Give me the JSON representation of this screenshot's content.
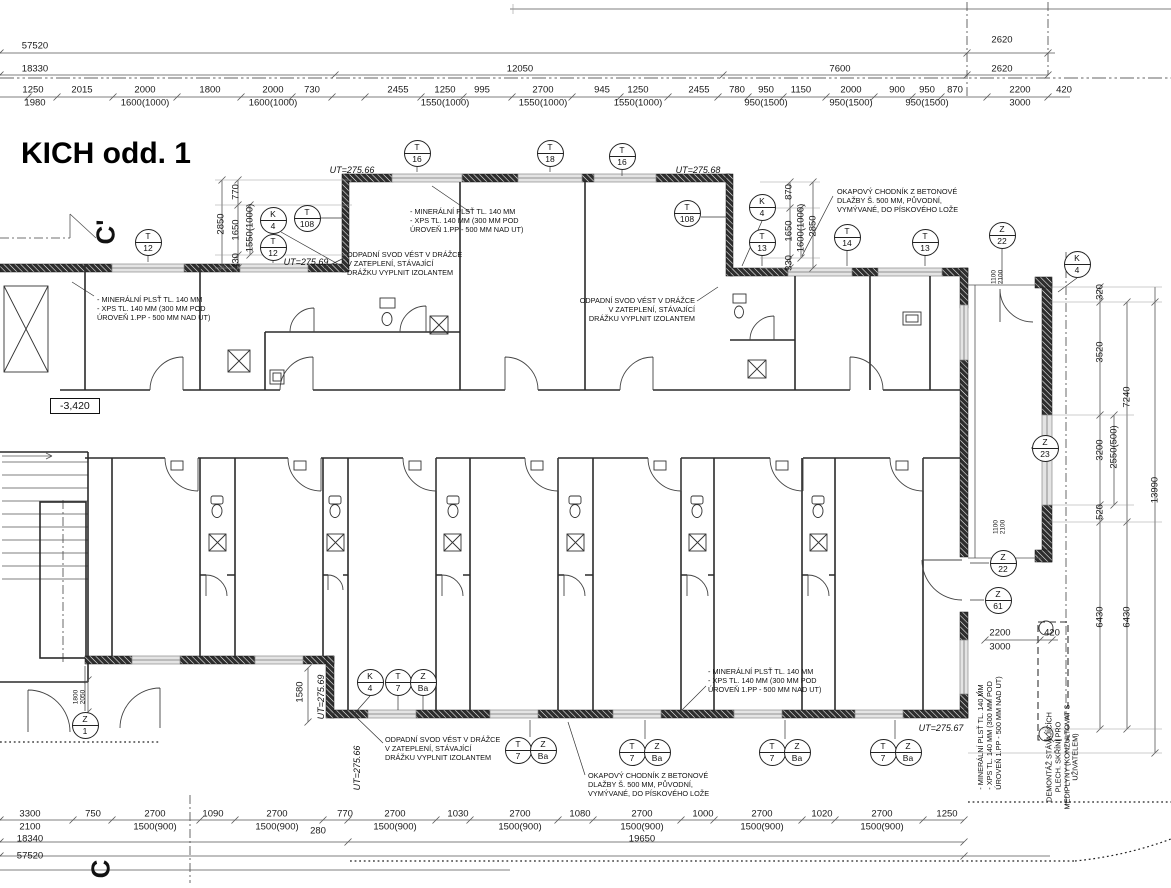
{
  "title": "KICH odd. 1",
  "colors": {
    "line": "#1a1a1a",
    "wall": "#111111",
    "dim": "#555555",
    "window_fill": "#e4e4e4",
    "bg": "#ffffff"
  },
  "level_label": {
    "t": "-3,420",
    "x": 50,
    "y": 398
  },
  "section_marks": [
    {
      "t": "C'",
      "x": 106,
      "y": 232
    },
    {
      "t": "C",
      "x": 101,
      "y": 869
    }
  ],
  "ut_labels": [
    {
      "t": "UT=275.66",
      "x": 352,
      "y": 170
    },
    {
      "t": "UT=275.68",
      "x": 698,
      "y": 170
    },
    {
      "t": "UT=275.69",
      "x": 306,
      "y": 262
    },
    {
      "t": "UT=275.67",
      "x": 941,
      "y": 728
    },
    {
      "t": "UT=275.69",
      "x": 321,
      "y": 697,
      "r": 1
    },
    {
      "t": "UT=275.66",
      "x": 357,
      "y": 768,
      "r": 1
    }
  ],
  "markers": [
    {
      "a": "T",
      "b": "12",
      "x": 148,
      "y": 242
    },
    {
      "a": "K",
      "b": "4",
      "x": 273,
      "y": 220
    },
    {
      "a": "T",
      "b": "108",
      "x": 307,
      "y": 218
    },
    {
      "a": "T",
      "b": "12",
      "x": 273,
      "y": 247
    },
    {
      "a": "T",
      "b": "16",
      "x": 417,
      "y": 153
    },
    {
      "a": "T",
      "b": "18",
      "x": 550,
      "y": 153
    },
    {
      "a": "T",
      "b": "16",
      "x": 622,
      "y": 156
    },
    {
      "a": "T",
      "b": "108",
      "x": 687,
      "y": 213
    },
    {
      "a": "K",
      "b": "4",
      "x": 762,
      "y": 207
    },
    {
      "a": "T",
      "b": "13",
      "x": 762,
      "y": 242
    },
    {
      "a": "T",
      "b": "14",
      "x": 847,
      "y": 237
    },
    {
      "a": "T",
      "b": "13",
      "x": 925,
      "y": 242
    },
    {
      "a": "Z",
      "b": "22",
      "x": 1002,
      "y": 235
    },
    {
      "a": "K",
      "b": "4",
      "x": 1077,
      "y": 264
    },
    {
      "a": "Z",
      "b": "23",
      "x": 1045,
      "y": 448
    },
    {
      "a": "Z",
      "b": "22",
      "x": 1003,
      "y": 563
    },
    {
      "a": "Z",
      "b": "61",
      "x": 998,
      "y": 600
    },
    {
      "a": "Z",
      "b": "1",
      "x": 85,
      "y": 725
    },
    {
      "a": "K",
      "b": "4",
      "x": 370,
      "y": 682
    },
    {
      "a": "T",
      "b": "7",
      "x": 398,
      "y": 682
    },
    {
      "a": "Z",
      "b": "Ba",
      "x": 423,
      "y": 682
    },
    {
      "a": "T",
      "b": "7",
      "x": 518,
      "y": 750
    },
    {
      "a": "Z",
      "b": "Ba",
      "x": 543,
      "y": 750
    },
    {
      "a": "T",
      "b": "7",
      "x": 632,
      "y": 752
    },
    {
      "a": "Z",
      "b": "Ba",
      "x": 657,
      "y": 752
    },
    {
      "a": "T",
      "b": "7",
      "x": 772,
      "y": 752
    },
    {
      "a": "Z",
      "b": "Ba",
      "x": 797,
      "y": 752
    },
    {
      "a": "T",
      "b": "7",
      "x": 883,
      "y": 752
    },
    {
      "a": "Z",
      "b": "Ba",
      "x": 908,
      "y": 752
    }
  ],
  "annotations": [
    {
      "lines": [
        "- MINERÁLNÍ PLSŤ TL. 140 MM",
        "- XPS TL. 140 MM (300 MM POD",
        "  ÚROVEŇ 1.PP -  500 MM NAD UT)"
      ],
      "x": 97,
      "y": 296
    },
    {
      "lines": [
        "- MINERÁLNÍ PLSŤ TL. 140 MM",
        "- XPS TL. 140 MM (300 MM POD",
        "  ÚROVEŇ 1.PP -  500 MM NAD UT)"
      ],
      "x": 410,
      "y": 208
    },
    {
      "lines": [
        "- MINERÁLNÍ PLSŤ TL. 140 MM",
        "- XPS TL. 140 MM (300 MM POD",
        "  ÚROVEŇ 1.PP -  500 MM NAD UT)"
      ],
      "x": 708,
      "y": 668
    },
    {
      "lines": [
        "- MINERÁLNÍ PLSŤ TL. 140 MM",
        "- XPS TL. 140 MM (300 MM POD",
        "  ÚROVEŇ 1.PP -  500 MM NAD UT)"
      ],
      "x": 990,
      "y": 733,
      "rot": 1
    },
    {
      "lines": [
        "ODPADNÍ SVOD VÉST V DRÁŽCE",
        "V ZATEPLENÍ, STÁVAJÍCÍ",
        "DRÁŽKU VYPLNIT IZOLANTEM"
      ],
      "x": 347,
      "y": 251
    },
    {
      "lines": [
        "ODPADNÍ SVOD VÉST V DRÁŽCE",
        "V ZATEPLENÍ, STÁVAJÍCÍ",
        "DRÁŽKU VYPLNIT IZOLANTEM"
      ],
      "x": 695,
      "y": 297,
      "align": "right"
    },
    {
      "lines": [
        "ODPADNÍ SVOD VÉST V DRÁŽCE",
        "V ZATEPLENÍ, STÁVAJÍCÍ",
        "DRÁŽKU VYPLNIT IZOLANTEM"
      ],
      "x": 385,
      "y": 736
    },
    {
      "lines": [
        "OKAPOVÝ CHODNÍK Z BETONOVÉ",
        "DLAŽBY Š. 500 MM, PŮVODNÍ,",
        "VYMÝVANÉ, DO PÍSKOVÉHO LOŽE"
      ],
      "x": 837,
      "y": 188
    },
    {
      "lines": [
        "OKAPOVÝ CHODNÍK Z BETONOVÉ",
        "DLAŽBY Š. 500 MM, PŮVODNÍ,",
        "VYMÝVANÉ, DO PÍSKOVÉHO LOŽE"
      ],
      "x": 588,
      "y": 772
    },
    {
      "lines": [
        "DEMONTÁŽ STÁVAJÍCÍCH",
        "PLECH. SKŘÍNÍ PRO",
        "MEDIPLYNY (KONZULTOVAT S",
        "UŽIVATELEM)"
      ],
      "x": 1063,
      "y": 757,
      "rot": 1,
      "center": 1
    }
  ],
  "dim_labels": [
    {
      "t": "57520",
      "x": 35,
      "y": 46
    },
    {
      "t": "2620",
      "x": 1002,
      "y": 40
    },
    {
      "t": "18330",
      "x": 35,
      "y": 69
    },
    {
      "t": "12050",
      "x": 520,
      "y": 69
    },
    {
      "t": "7600",
      "x": 840,
      "y": 69
    },
    {
      "t": "2620",
      "x": 1002,
      "y": 69
    },
    {
      "t": "1250",
      "x": 33,
      "y": 90
    },
    {
      "t": "2015",
      "x": 82,
      "y": 90
    },
    {
      "t": "2000",
      "x": 145,
      "y": 90
    },
    {
      "t": "1800",
      "x": 210,
      "y": 90
    },
    {
      "t": "2000",
      "x": 273,
      "y": 90
    },
    {
      "t": "730",
      "x": 312,
      "y": 90
    },
    {
      "t": "2455",
      "x": 398,
      "y": 90
    },
    {
      "t": "1250",
      "x": 445,
      "y": 90
    },
    {
      "t": "995",
      "x": 482,
      "y": 90
    },
    {
      "t": "2700",
      "x": 543,
      "y": 90
    },
    {
      "t": "945",
      "x": 602,
      "y": 90
    },
    {
      "t": "1250",
      "x": 638,
      "y": 90
    },
    {
      "t": "2455",
      "x": 699,
      "y": 90
    },
    {
      "t": "780",
      "x": 737,
      "y": 90
    },
    {
      "t": "950",
      "x": 766,
      "y": 90
    },
    {
      "t": "1150",
      "x": 801,
      "y": 90
    },
    {
      "t": "2000",
      "x": 851,
      "y": 90
    },
    {
      "t": "900",
      "x": 897,
      "y": 90
    },
    {
      "t": "950",
      "x": 927,
      "y": 90
    },
    {
      "t": "870",
      "x": 955,
      "y": 90
    },
    {
      "t": "2200",
      "x": 1020,
      "y": 90
    },
    {
      "t": "420",
      "x": 1064,
      "y": 90
    },
    {
      "t": "1980",
      "x": 35,
      "y": 103
    },
    {
      "t": "1600(1000)",
      "x": 145,
      "y": 103
    },
    {
      "t": "1600(1000)",
      "x": 273,
      "y": 103
    },
    {
      "t": "1550(1000)",
      "x": 445,
      "y": 103
    },
    {
      "t": "1550(1000)",
      "x": 543,
      "y": 103
    },
    {
      "t": "1550(1000)",
      "x": 638,
      "y": 103
    },
    {
      "t": "950(1500)",
      "x": 766,
      "y": 103
    },
    {
      "t": "950(1500)",
      "x": 851,
      "y": 103
    },
    {
      "t": "950(1500)",
      "x": 927,
      "y": 103
    },
    {
      "t": "3000",
      "x": 1020,
      "y": 103
    },
    {
      "t": "770",
      "x": 236,
      "y": 192,
      "r": 1
    },
    {
      "t": "2850",
      "x": 221,
      "y": 224,
      "r": 1
    },
    {
      "t": "1650",
      "x": 236,
      "y": 230,
      "r": 1
    },
    {
      "t": "1550(1000)",
      "x": 250,
      "y": 228,
      "r": 1
    },
    {
      "t": "430",
      "x": 236,
      "y": 261,
      "r": 1
    },
    {
      "t": "870",
      "x": 789,
      "y": 192,
      "r": 1
    },
    {
      "t": "1650",
      "x": 789,
      "y": 231,
      "r": 1
    },
    {
      "t": "1600(1000)",
      "x": 801,
      "y": 228,
      "r": 1
    },
    {
      "t": "2850",
      "x": 813,
      "y": 226,
      "r": 1
    },
    {
      "t": "330",
      "x": 789,
      "y": 263,
      "r": 1
    },
    {
      "t": "320",
      "x": 1100,
      "y": 292,
      "r": 1
    },
    {
      "t": "3520",
      "x": 1100,
      "y": 352,
      "r": 1
    },
    {
      "t": "3200",
      "x": 1100,
      "y": 450,
      "r": 1
    },
    {
      "t": "520",
      "x": 1100,
      "y": 512,
      "r": 1
    },
    {
      "t": "6430",
      "x": 1100,
      "y": 617,
      "r": 1
    },
    {
      "t": "2550(500)",
      "x": 1114,
      "y": 447,
      "r": 1
    },
    {
      "t": "7240",
      "x": 1127,
      "y": 397,
      "r": 1
    },
    {
      "t": "6430",
      "x": 1127,
      "y": 617,
      "r": 1
    },
    {
      "t": "13990",
      "x": 1155,
      "y": 490,
      "r": 1
    },
    {
      "t": "2200",
      "x": 1000,
      "y": 633
    },
    {
      "t": "3000",
      "x": 1000,
      "y": 647
    },
    {
      "t": "420",
      "x": 1052,
      "y": 633
    },
    {
      "t": "1580",
      "x": 300,
      "y": 692,
      "r": 1
    },
    {
      "t": "1100",
      "x": 994,
      "y": 277,
      "r": 1,
      "s": 1
    },
    {
      "t": "2100",
      "x": 1001,
      "y": 277,
      "r": 1,
      "s": 1
    },
    {
      "t": "1100",
      "x": 996,
      "y": 527,
      "r": 1,
      "s": 1
    },
    {
      "t": "2100",
      "x": 1003,
      "y": 527,
      "r": 1,
      "s": 1
    },
    {
      "t": "1800",
      "x": 76,
      "y": 697,
      "r": 1,
      "s": 1
    },
    {
      "t": "2050",
      "x": 83,
      "y": 697,
      "r": 1,
      "s": 1
    },
    {
      "t": "3300",
      "x": 30,
      "y": 814
    },
    {
      "t": "750",
      "x": 93,
      "y": 814
    },
    {
      "t": "2700",
      "x": 155,
      "y": 814
    },
    {
      "t": "1090",
      "x": 213,
      "y": 814
    },
    {
      "t": "2700",
      "x": 277,
      "y": 814
    },
    {
      "t": "770",
      "x": 345,
      "y": 814
    },
    {
      "t": "2700",
      "x": 395,
      "y": 814
    },
    {
      "t": "1030",
      "x": 458,
      "y": 814
    },
    {
      "t": "2700",
      "x": 520,
      "y": 814
    },
    {
      "t": "1080",
      "x": 580,
      "y": 814
    },
    {
      "t": "2700",
      "x": 642,
      "y": 814
    },
    {
      "t": "1000",
      "x": 703,
      "y": 814
    },
    {
      "t": "2700",
      "x": 762,
      "y": 814
    },
    {
      "t": "1020",
      "x": 822,
      "y": 814
    },
    {
      "t": "2700",
      "x": 882,
      "y": 814
    },
    {
      "t": "1250",
      "x": 947,
      "y": 814
    },
    {
      "t": "2100",
      "x": 30,
      "y": 827
    },
    {
      "t": "1500(900)",
      "x": 155,
      "y": 827
    },
    {
      "t": "1500(900)",
      "x": 277,
      "y": 827
    },
    {
      "t": "1500(900)",
      "x": 395,
      "y": 827
    },
    {
      "t": "1500(900)",
      "x": 520,
      "y": 827
    },
    {
      "t": "1500(900)",
      "x": 642,
      "y": 827
    },
    {
      "t": "1500(900)",
      "x": 762,
      "y": 827
    },
    {
      "t": "1500(900)",
      "x": 882,
      "y": 827
    },
    {
      "t": "280",
      "x": 318,
      "y": 831
    },
    {
      "t": "19650",
      "x": 642,
      "y": 839
    },
    {
      "t": "18340",
      "x": 30,
      "y": 839
    },
    {
      "t": "57520",
      "x": 30,
      "y": 856
    }
  ]
}
